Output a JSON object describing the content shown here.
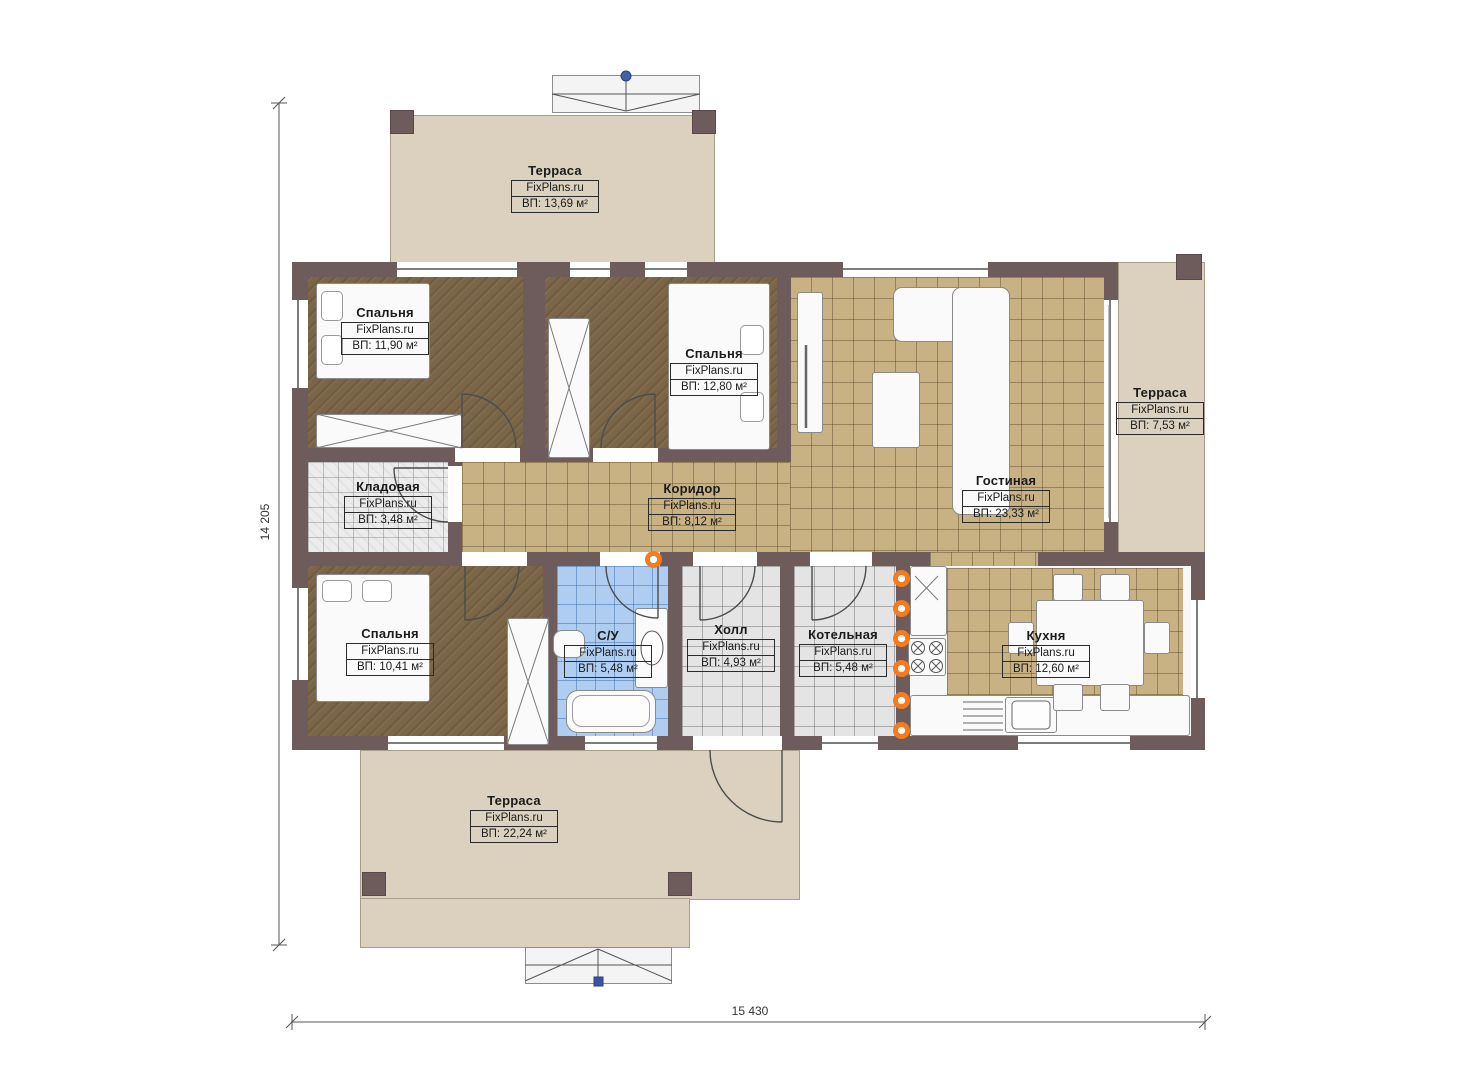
{
  "brand": "FixPlans.ru",
  "dimensions": {
    "height": "14 205",
    "width": "15 430"
  },
  "rooms": [
    {
      "id": "terrace-top",
      "name": "Терраса",
      "brand": "FixPlans.ru",
      "area": "ВП: 13,69 м²"
    },
    {
      "id": "bedroom-1",
      "name": "Спальня",
      "brand": "FixPlans.ru",
      "area": "ВП: 11,90 м²"
    },
    {
      "id": "bedroom-2",
      "name": "Спальня",
      "brand": "FixPlans.ru",
      "area": "ВП: 12,80 м²"
    },
    {
      "id": "terrace-right",
      "name": "Терраса",
      "brand": "FixPlans.ru",
      "area": "ВП: 7,53 м²"
    },
    {
      "id": "storage",
      "name": "Кладовая",
      "brand": "FixPlans.ru",
      "area": "ВП: 3,48 м²"
    },
    {
      "id": "corridor",
      "name": "Коридор",
      "brand": "FixPlans.ru",
      "area": "ВП: 8,12 м²"
    },
    {
      "id": "living-room",
      "name": "Гостиная",
      "brand": "FixPlans.ru",
      "area": "ВП: 23,33 м²"
    },
    {
      "id": "bedroom-3",
      "name": "Спальня",
      "brand": "FixPlans.ru",
      "area": "ВП: 10,41 м²"
    },
    {
      "id": "bathroom",
      "name": "С/У",
      "brand": "FixPlans.ru",
      "area": "ВП: 5,48 м²"
    },
    {
      "id": "hall",
      "name": "Холл",
      "brand": "FixPlans.ru",
      "area": "ВП: 4,93 м²"
    },
    {
      "id": "boiler-room",
      "name": "Котельная",
      "brand": "FixPlans.ru",
      "area": "ВП: 5,48 м²"
    },
    {
      "id": "kitchen",
      "name": "Кухня",
      "brand": "FixPlans.ru",
      "area": "ВП: 12,60 м²"
    },
    {
      "id": "terrace-bottom",
      "name": "Терраса",
      "brand": "FixPlans.ru",
      "area": "ВП: 22,24 м²"
    }
  ],
  "colors": {
    "wall": "#6e5c5c",
    "terrace_floor": "#dcd1bf",
    "wood_floor": "#7a6547",
    "tile_tan": "#c8b284",
    "tile_gray": "#e4e4e4",
    "tile_blue": "#aecdf0",
    "radiator": "#f47b20",
    "marker_blue": "#3f64a8"
  }
}
